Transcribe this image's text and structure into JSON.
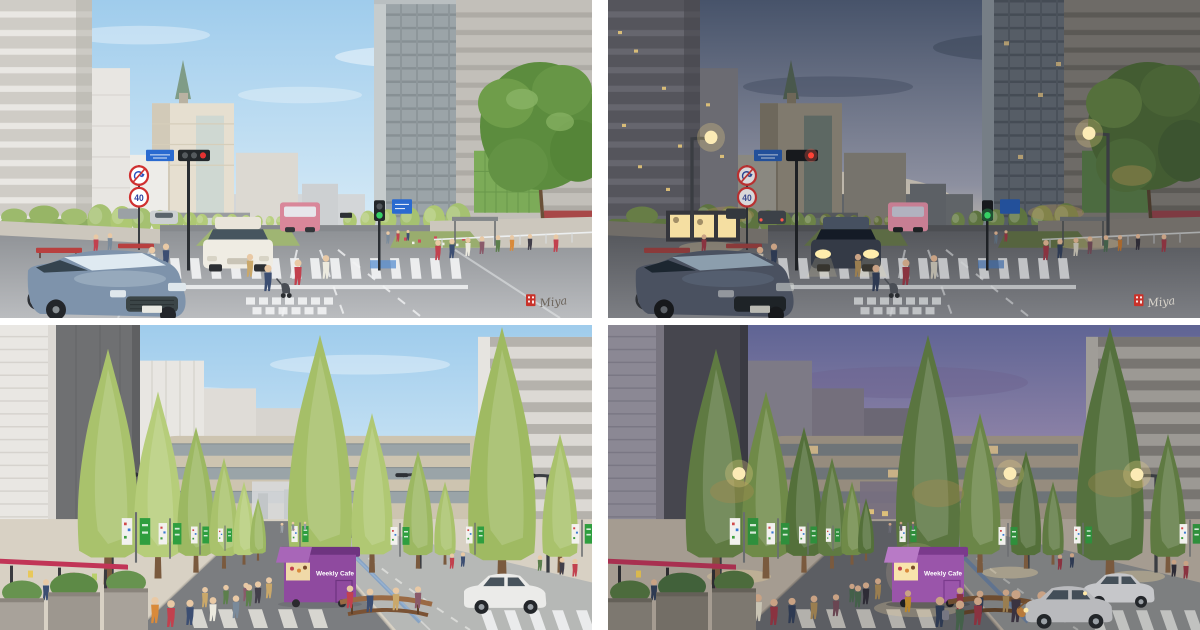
{
  "labels": {
    "signature": "Miya",
    "kiosk": "Weekly Cafe",
    "speed_limit": "40"
  },
  "colors": {
    "sky_day_top": "#9fccec",
    "sky_day_bottom": "#ddeef8",
    "sky_dusk_top": "#47536a",
    "sky_dusk_glow": "#d9cdb2",
    "sky_night_top": "#5f6494",
    "sky_night_pink": "#c9abb4",
    "banner_green": "#2f9e3f",
    "banner_green_dusk": "#2f8f3c",
    "kiosk_purple": "#8f4a9f",
    "kiosk_purple_dusk": "#9a55aa",
    "terrace_red": "#c13557",
    "seal_red": "#c9322a"
  }
}
